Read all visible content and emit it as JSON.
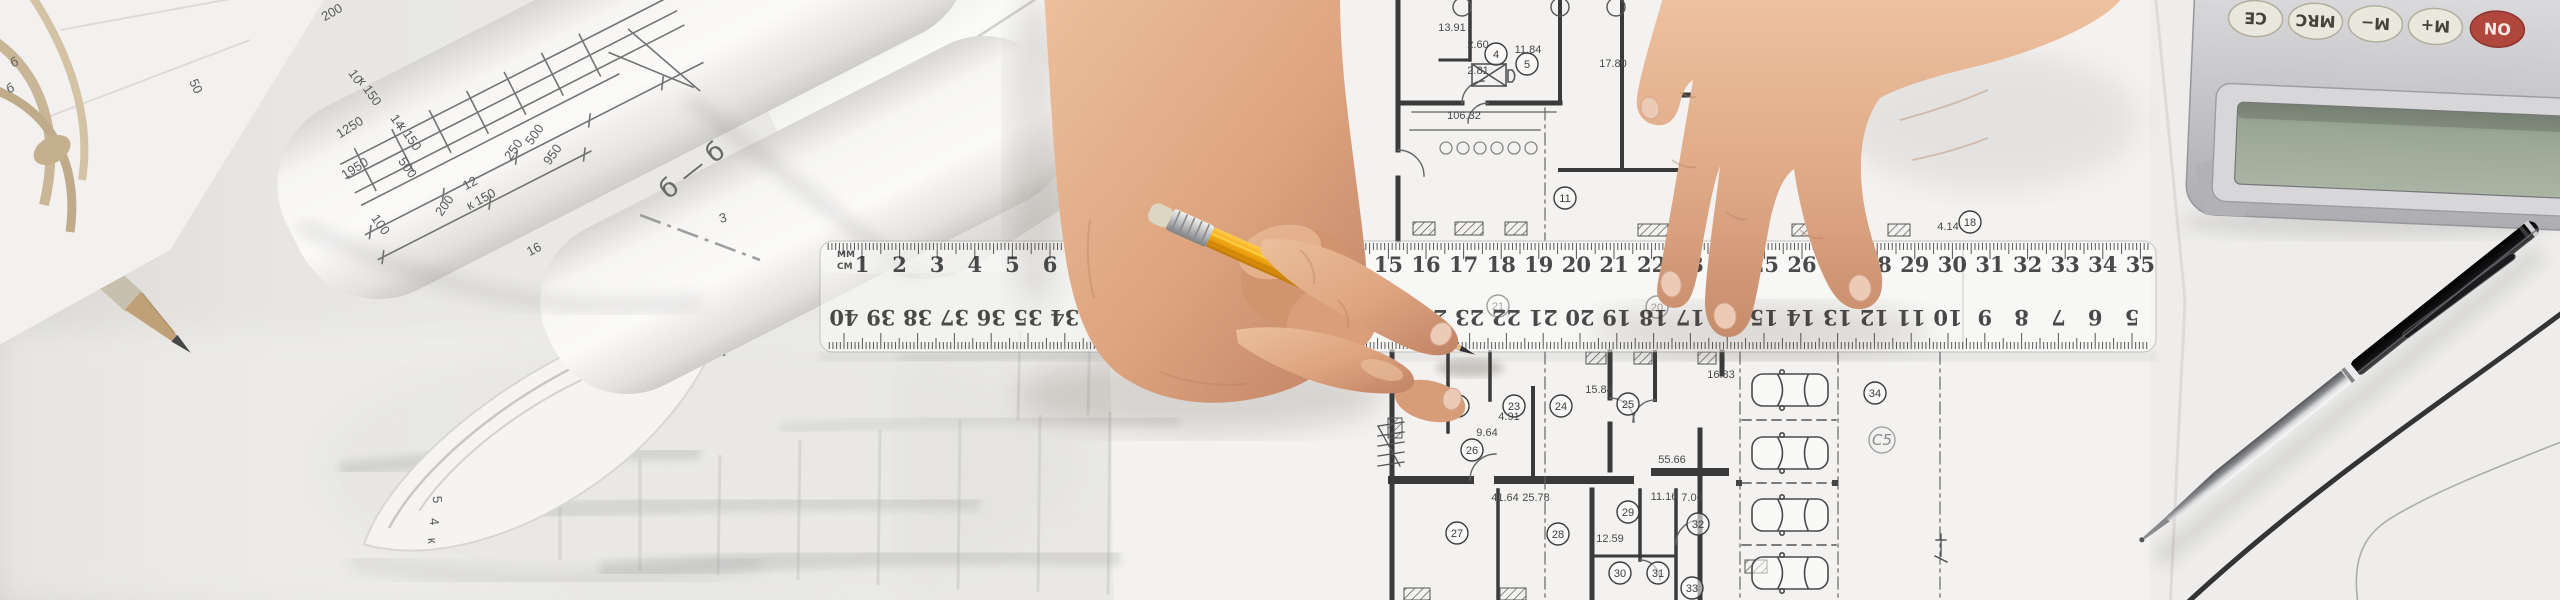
{
  "colors": {
    "desk": "#e9e8e5",
    "paper": "#f3f2f0",
    "blueprint_line": "#3f3f3f",
    "skin_light": "#eec49f",
    "skin_mid": "#d89e7b",
    "skin_dark": "#ad7658",
    "pencil_yellow": "#f2a71a",
    "lcd_green": "#9aa694",
    "on_button_red": "#b0473d",
    "button_cream": "#eae8dc",
    "calculator_silver": "#c9c9cc",
    "pen_black": "#151515",
    "rope_tan": "#c9b697"
  },
  "ruler": {
    "unit_top": "MM",
    "unit_bottom": "CM",
    "top_numbers": [
      1,
      2,
      3,
      4,
      5,
      6,
      7,
      8,
      9,
      10,
      11,
      12,
      13,
      14,
      15,
      16,
      17,
      18,
      19,
      20,
      21,
      22,
      23,
      24,
      25,
      26,
      27,
      28,
      29,
      30,
      31,
      32,
      33,
      34,
      35
    ],
    "bottom_numbers": [
      40,
      39,
      38,
      37,
      36,
      35,
      34,
      33,
      32,
      31,
      30,
      29,
      28,
      27,
      26,
      25,
      24,
      23,
      22,
      21,
      20,
      19,
      18,
      17,
      16,
      15,
      14,
      13,
      12,
      11,
      10,
      9,
      8,
      7,
      6,
      5
    ]
  },
  "calculator": {
    "buttons": [
      "CE",
      "MRC",
      "M−",
      "M+",
      "ON"
    ]
  },
  "plan": {
    "rooms": [
      {
        "n": "4",
        "x": 1496,
        "y": 54
      },
      {
        "n": "5",
        "x": 1527,
        "y": 64
      },
      {
        "n": "11",
        "x": 1565,
        "y": 198
      },
      {
        "n": "18",
        "x": 1970,
        "y": 222
      },
      {
        "n": "20",
        "x": 1657,
        "y": 307
      },
      {
        "n": "21",
        "x": 1498,
        "y": 306
      },
      {
        "n": "22",
        "x": 1458,
        "y": 406
      },
      {
        "n": "23",
        "x": 1514,
        "y": 406
      },
      {
        "n": "24",
        "x": 1561,
        "y": 406
      },
      {
        "n": "25",
        "x": 1628,
        "y": 404
      },
      {
        "n": "26",
        "x": 1472,
        "y": 450
      },
      {
        "n": "27",
        "x": 1457,
        "y": 533
      },
      {
        "n": "28",
        "x": 1558,
        "y": 534
      },
      {
        "n": "29",
        "x": 1628,
        "y": 512
      },
      {
        "n": "30",
        "x": 1620,
        "y": 573
      },
      {
        "n": "31",
        "x": 1658,
        "y": 573
      },
      {
        "n": "32",
        "x": 1698,
        "y": 524
      },
      {
        "n": "33",
        "x": 1692,
        "y": 588
      },
      {
        "n": "34",
        "x": 1875,
        "y": 393
      }
    ],
    "dimensions": [
      {
        "t": "13.91",
        "x": 1452,
        "y": 31
      },
      {
        "t": "2.60",
        "x": 1478,
        "y": 48
      },
      {
        "t": "2.81",
        "x": 1478,
        "y": 74
      },
      {
        "t": "11.84",
        "x": 1528,
        "y": 53
      },
      {
        "t": "17.80",
        "x": 1613,
        "y": 67
      },
      {
        "t": "106.32",
        "x": 1464,
        "y": 119
      },
      {
        "t": "4.14",
        "x": 1948,
        "y": 230
      },
      {
        "t": "15.84",
        "x": 1599,
        "y": 393
      },
      {
        "t": "16.83",
        "x": 1721,
        "y": 378
      },
      {
        "t": "4.91",
        "x": 1509,
        "y": 420
      },
      {
        "t": "9.64",
        "x": 1487,
        "y": 436
      },
      {
        "t": "55.66",
        "x": 1672,
        "y": 463
      },
      {
        "t": "41.64",
        "x": 1505,
        "y": 501
      },
      {
        "t": "25.78",
        "x": 1536,
        "y": 501
      },
      {
        "t": "11.16",
        "x": 1664,
        "y": 500
      },
      {
        "t": "7.06",
        "x": 1692,
        "y": 501
      },
      {
        "t": "12.59",
        "x": 1610,
        "y": 542
      }
    ],
    "handwritten_mark": {
      "t": "C5",
      "x": 1882,
      "y": 445
    },
    "cars": [
      {
        "x": 1752,
        "y": 374
      },
      {
        "x": 1752,
        "y": 437
      },
      {
        "x": 1752,
        "y": 499
      },
      {
        "x": 1752,
        "y": 557
      }
    ]
  },
  "rolls": {
    "section_label": "б — б",
    "annotations": [
      {
        "t": "б",
        "x": 16,
        "y": 66,
        "r": -25
      },
      {
        "t": "б",
        "x": 12,
        "y": 92,
        "r": -25
      },
      {
        "t": "50",
        "x": 192,
        "y": 88,
        "r": 65
      },
      {
        "t": "200",
        "x": 334,
        "y": 16,
        "r": -30
      },
      {
        "t": "10",
        "x": 352,
        "y": 79,
        "r": 55
      },
      {
        "t": "к 150",
        "x": 366,
        "y": 94,
        "r": 55
      },
      {
        "t": "1250",
        "x": 352,
        "y": 131,
        "r": -32
      },
      {
        "t": "14",
        "x": 394,
        "y": 124,
        "r": 55
      },
      {
        "t": "к 150",
        "x": 406,
        "y": 139,
        "r": 55
      },
      {
        "t": "1950",
        "x": 357,
        "y": 172,
        "r": -32
      },
      {
        "t": "500",
        "x": 404,
        "y": 170,
        "r": 55
      },
      {
        "t": "100",
        "x": 377,
        "y": 227,
        "r": 55
      },
      {
        "t": "500",
        "x": 538,
        "y": 137,
        "r": -55
      },
      {
        "t": "250",
        "x": 517,
        "y": 152,
        "r": -55
      },
      {
        "t": "950",
        "x": 556,
        "y": 157,
        "r": -55
      },
      {
        "t": "12",
        "x": 472,
        "y": 187,
        "r": -28
      },
      {
        "t": "к 150",
        "x": 483,
        "y": 203,
        "r": -28
      },
      {
        "t": "200",
        "x": 448,
        "y": 208,
        "r": -55
      },
      {
        "t": "16",
        "x": 536,
        "y": 253,
        "r": -28
      },
      {
        "t": "3",
        "x": 724,
        "y": 222,
        "r": -15
      },
      {
        "t": "5",
        "x": 433,
        "y": 500,
        "r": 85
      },
      {
        "t": "4",
        "x": 430,
        "y": 522,
        "r": 85
      },
      {
        "t": "к",
        "x": 428,
        "y": 541,
        "r": 85
      }
    ]
  }
}
